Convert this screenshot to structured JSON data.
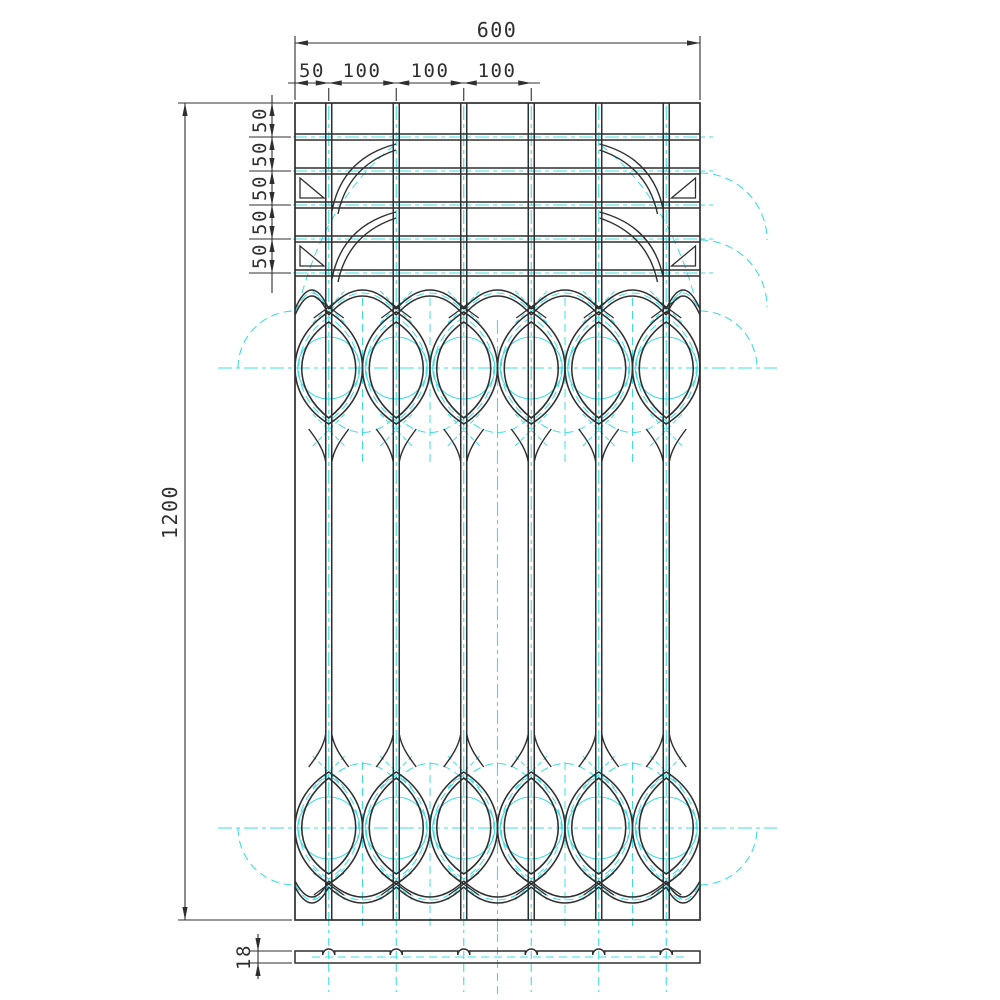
{
  "drawing": {
    "dims": {
      "overall_width": "600",
      "top_chain": [
        "50",
        "100",
        "100",
        "100"
      ],
      "overall_height": "1200",
      "left_chain": [
        "50",
        "50",
        "50",
        "50",
        "50"
      ],
      "thickness": "18"
    },
    "colors": {
      "object_line": "#2f2f2f",
      "centerline": "#3cdce6",
      "background": "#ffffff"
    }
  }
}
